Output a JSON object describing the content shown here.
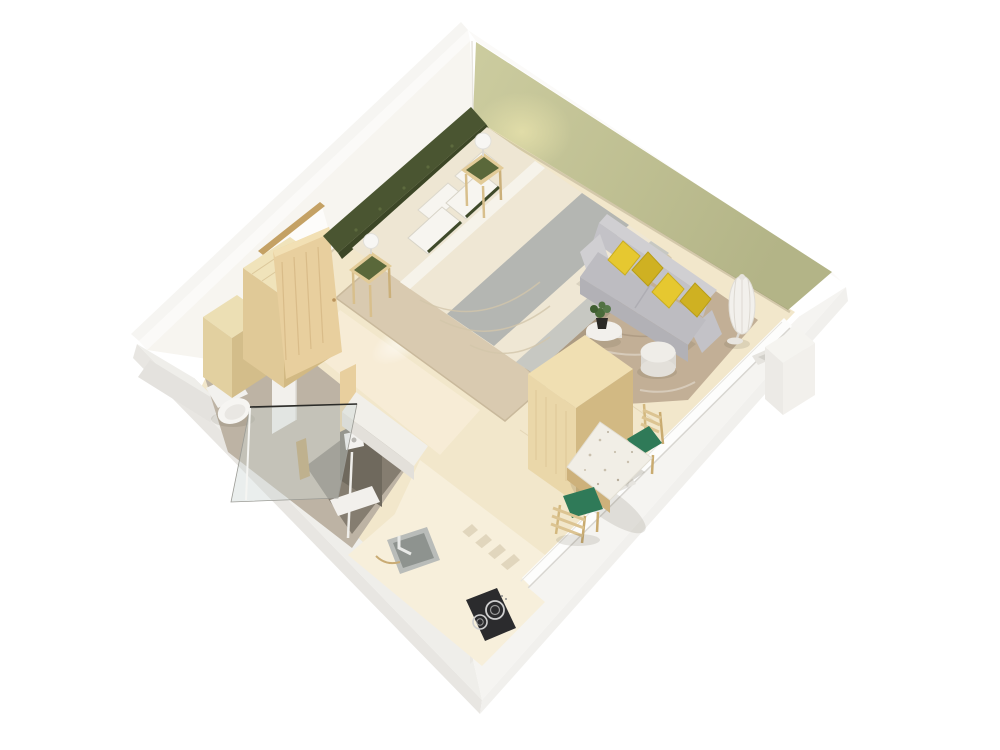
{
  "scene": {
    "description": "3D isometric cutaway render of a studio apartment floor plan with sleeping area, living area, bathroom, kitchen and dining nook",
    "view": "isometric cutaway, tall rear walls, low front walls with window openings"
  },
  "colors": {
    "bg": "#ffffff",
    "wall_top": "#fbfaf8",
    "wall_inner_white": "#f7f5f0",
    "wall_outer_left": "#e8e6e2",
    "wall_outer_right": "#f1f0ed",
    "band_left": "#efeeea",
    "band_right": "#f5f4f1",
    "band_inner_left": "#d7d5d1",
    "band_inner_right": "#eae8e3",
    "olive_light": "#cccc9f",
    "olive_dark": "#b3b487",
    "floor_wood": "#f2e7cb",
    "floor_kitchen": "#f7efdb",
    "floor_bright": "#f7eed8",
    "rug_tan": "#d9cab0",
    "rug_brown": "#c2af96",
    "headboard_green": "#4a5531",
    "tuft_green": "#5d6a3e",
    "bed_cream": "#eee6d3",
    "bed_gray": "#b4b6b2",
    "bed_gray2": "#c0c2be",
    "sheet_white": "#f6f3ea",
    "pillow_white": "#f7f5f0",
    "pillow_trim": "#3f4a2a",
    "wood_light": "#ead7a9",
    "wood_mid": "#e0c997",
    "wood_dark": "#d2b983",
    "door_wood": "#e8cf9e",
    "frame_gold": "#c4a164",
    "sofa_light": "#d0cfd2",
    "sofa_mid": "#c3c2c7",
    "sofa_seat": "#bdbcc1",
    "sofa_dark": "#b2b1b6",
    "cushion_yellow": "#e6c830",
    "cushion_yellow_dark": "#cfb122",
    "white_obj": "#f2f0ec",
    "white_obj_shade": "#dcd9d3",
    "green_top": "#5a683a",
    "chair_green": "#2f7a58",
    "chair_wood": "#dcc492",
    "terrazzo": "#f1eee6",
    "bath_floor": "#bdb3a4",
    "shower_floor": "#857d70",
    "shower_wall": "#6f695d",
    "glass_tint": "rgba(205,215,212,0.42)",
    "brass": "#b5975c",
    "sink_gray": "#b9bcb9",
    "sink_basin": "#8e938f",
    "cooktop_black": "#2b2b2d",
    "burner_ring": "#cfcfcf",
    "plant_green": "#4a6b3a",
    "pot_black": "#2b2a26",
    "shadow_soft": "rgba(95,85,62,0.14)",
    "shadow_dark": "rgba(95,85,62,0.22)"
  },
  "rooms": [
    {
      "name": "sleeping-area",
      "items": [
        "double-bed",
        "tufted-headboard",
        "nightstand-upper",
        "nightstand-lower",
        "table-lamp-upper",
        "table-lamp-lower",
        "tan-area-rug"
      ]
    },
    {
      "name": "living-area",
      "items": [
        "gray-sofa",
        "yellow-cushions",
        "floor-vase-lamp",
        "ottoman-pouf",
        "round-side-table",
        "potted-plant",
        "marble-rug"
      ]
    },
    {
      "name": "bathroom",
      "items": [
        "toilet",
        "walk-in-shower",
        "glass-partition",
        "shower-head",
        "brass-column"
      ]
    },
    {
      "name": "kitchen",
      "items": [
        "countertop",
        "sink",
        "faucet",
        "cooktop",
        "tall-cabinet"
      ]
    },
    {
      "name": "dining-nook",
      "items": [
        "terrazzo-table",
        "dining-chair-upper",
        "dining-chair-lower"
      ]
    },
    {
      "name": "entry",
      "items": [
        "open-entry-door",
        "wardrobe",
        "closet-box"
      ]
    }
  ],
  "counts": {
    "yellow_cushions": 4,
    "dining_chairs": 2,
    "nightstands": 2,
    "cooktop_burners": 2,
    "window_walls": 2
  }
}
